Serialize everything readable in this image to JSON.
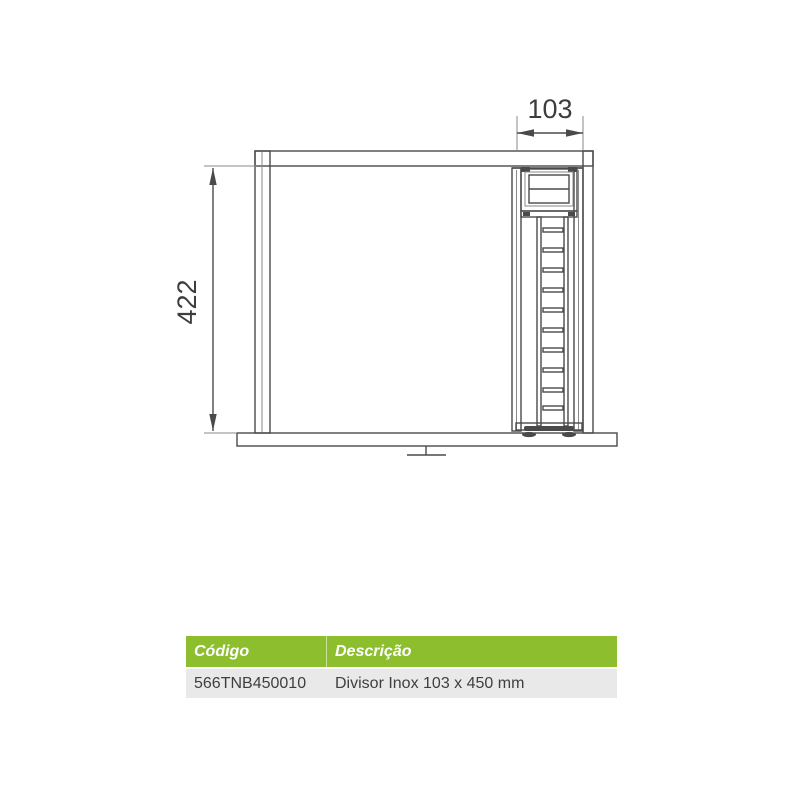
{
  "colors": {
    "line": "#4a4a4a",
    "line_thin": "#8a8a8a",
    "dim_text": "#3d3d3d",
    "header_bg": "#8cbe2e",
    "header_text": "#ffffff",
    "row_bg": "#e9e9e9",
    "row_text": "#3f3f3f"
  },
  "drawing": {
    "width_dimension": "103",
    "height_dimension": "422"
  },
  "table": {
    "header": {
      "codigo": "Código",
      "descricao": "Descrição"
    },
    "rows": [
      {
        "codigo": "566TNB450010",
        "descricao": "Divisor Inox 103 x 450 mm"
      }
    ]
  }
}
